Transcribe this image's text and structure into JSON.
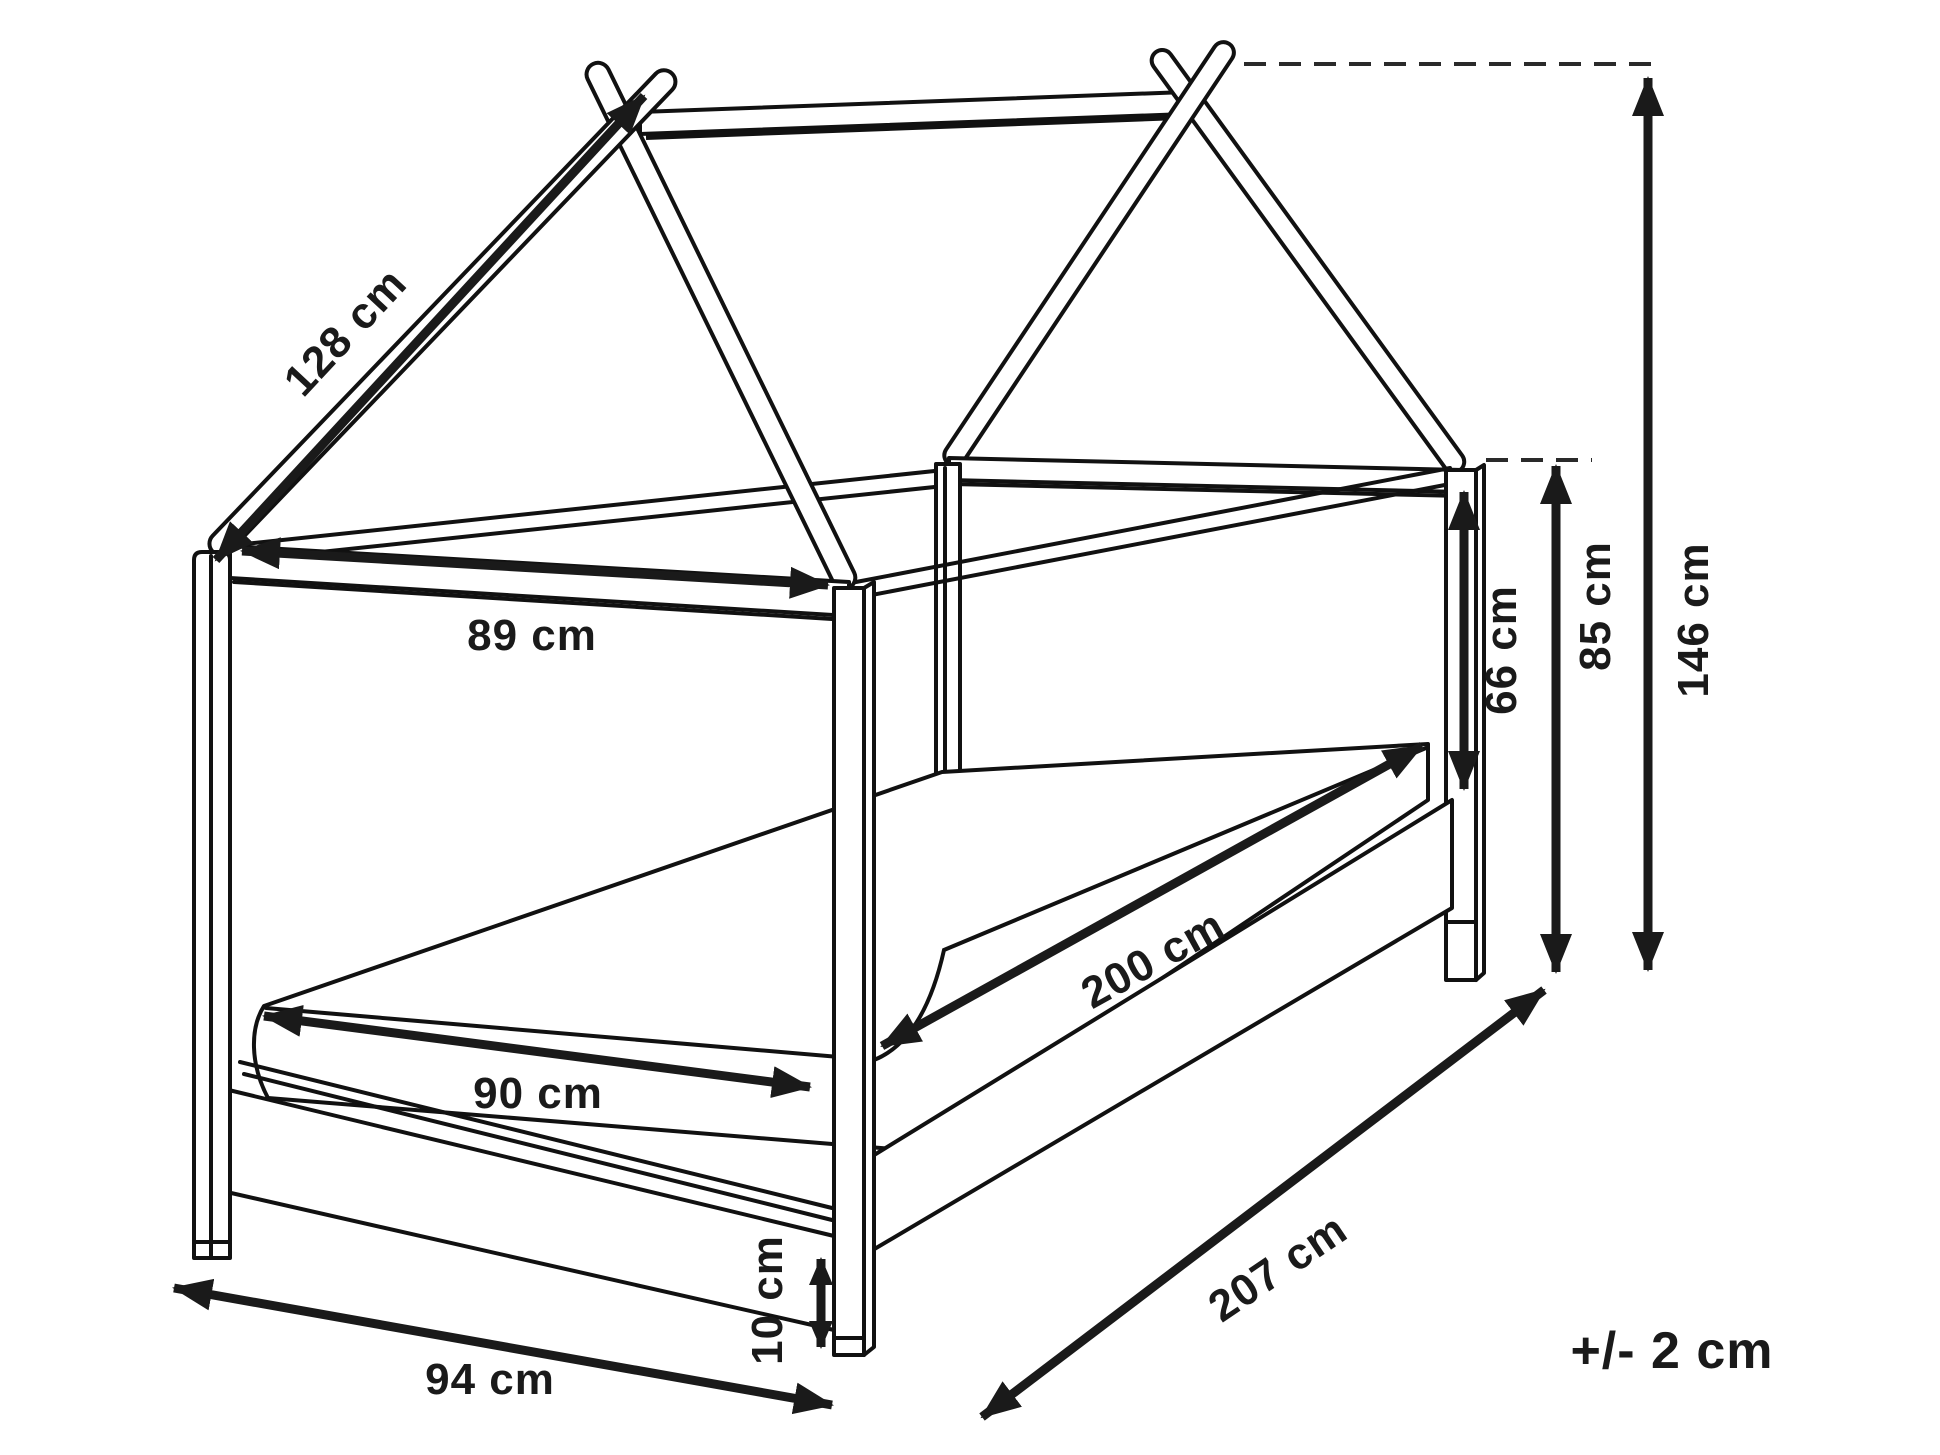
{
  "diagram": {
    "type": "furniture dimension line drawing",
    "subject": "house-frame single bed with mattress",
    "units": "cm"
  },
  "labels": {
    "slope": "128 cm",
    "top_width": "89 cm",
    "mattress_width": "90 cm",
    "mattress_length": "200 cm",
    "base_width": "94 cm",
    "base_length": "207 cm",
    "post_height": "66 cm",
    "side_height": "85 cm",
    "total_height": "146 cm",
    "clearance": "10 cm",
    "tolerance": "+/- 2 cm"
  },
  "colors": {
    "ink": "#1a1a1a",
    "line": "#111111",
    "background": "#ffffff"
  }
}
